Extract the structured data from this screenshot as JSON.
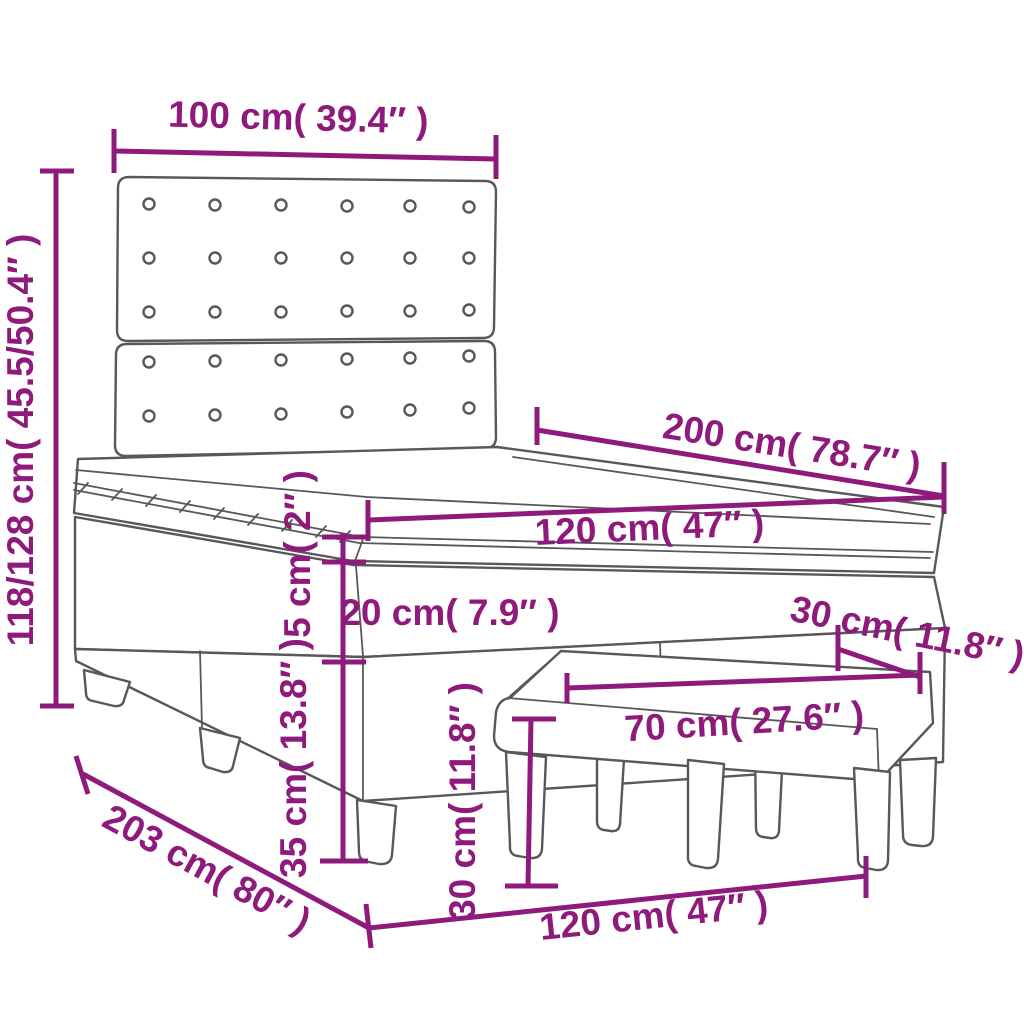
{
  "diagram": {
    "subject": "box spring bed with tufted headboard, topper and upholstered bench - dimension diagram",
    "accent_color": "#8e1a7c",
    "line_color": "#58585a",
    "background_color": "#ffffff",
    "dimensions": {
      "headboard_width": "100 cm( 39.4″ )",
      "overall_height": "118/128 cm( 45.5/50.4″ )",
      "bed_length": "200 cm( 78.7″ )",
      "bed_width_top": "120 cm( 47″ )",
      "topper_thickness": "5 cm( 2″ )",
      "mattress_thickness": "20 cm( 7.9″ )",
      "base_with_legs_height": "35 cm( 13.8″ )",
      "bench_depth": "30 cm( 11.8″ )",
      "bench_length": "70 cm( 27.6″ )",
      "bench_height": "30 cm( 11.8″ )",
      "base_length": "203 cm( 80″ )",
      "bed_width_bottom": "120 cm( 47″ )"
    }
  }
}
